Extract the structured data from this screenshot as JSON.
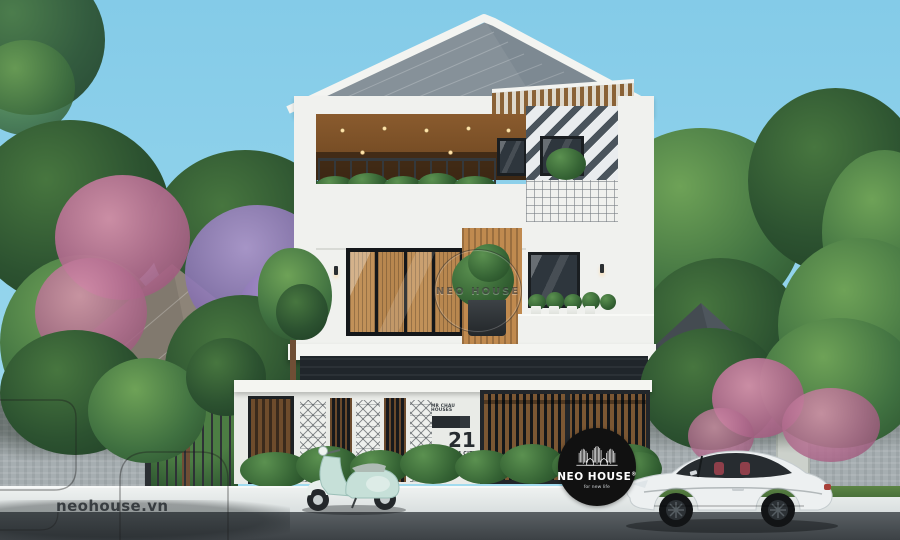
{
  "image": {
    "type": "architectural-exterior-render",
    "subject": "modern three-storey villa street elevation with car and scooter"
  },
  "watermarks": {
    "site_url": "neohouse.vn",
    "center_circle_label": "NEO HOUSE",
    "badge": {
      "brand": "NEO HOUSE",
      "registered_mark": "®",
      "tagline": "for new life"
    }
  },
  "gate_plate": {
    "owner": "MR CHAU HOUSES",
    "number": "21",
    "city": "HCM CITY"
  },
  "palette": {
    "sky": "#8fd0ea",
    "roof_metal": "#7d8992",
    "wood_accent": "#c08a4f",
    "soffit_wood": "#7a4f28",
    "cladding_dark": "#4a545c",
    "wall_white": "#f0f1ee",
    "foliage_green": "#3a6b3f",
    "flower_pink": "#c77a9b",
    "flower_purple": "#9a7fc0",
    "stone_wall": "#a6aeb1",
    "road": "#4c5257",
    "car_body": "#edf0f1",
    "scooter_body": "#c6e0d8",
    "badge_background": "#111111"
  },
  "scene_elements": [
    "slanted-metal-roof",
    "wood-pergola",
    "balcony-with-hedge",
    "chevron-cladding-tower",
    "black-frame-glass-doors",
    "white-perimeter-fence",
    "breeze-block-columns",
    "wooden-gates",
    "address-plate",
    "white-coupe-car",
    "mint-scooter",
    "flowering-trees",
    "stone-boundary-walls",
    "street-and-sidewalk"
  ]
}
